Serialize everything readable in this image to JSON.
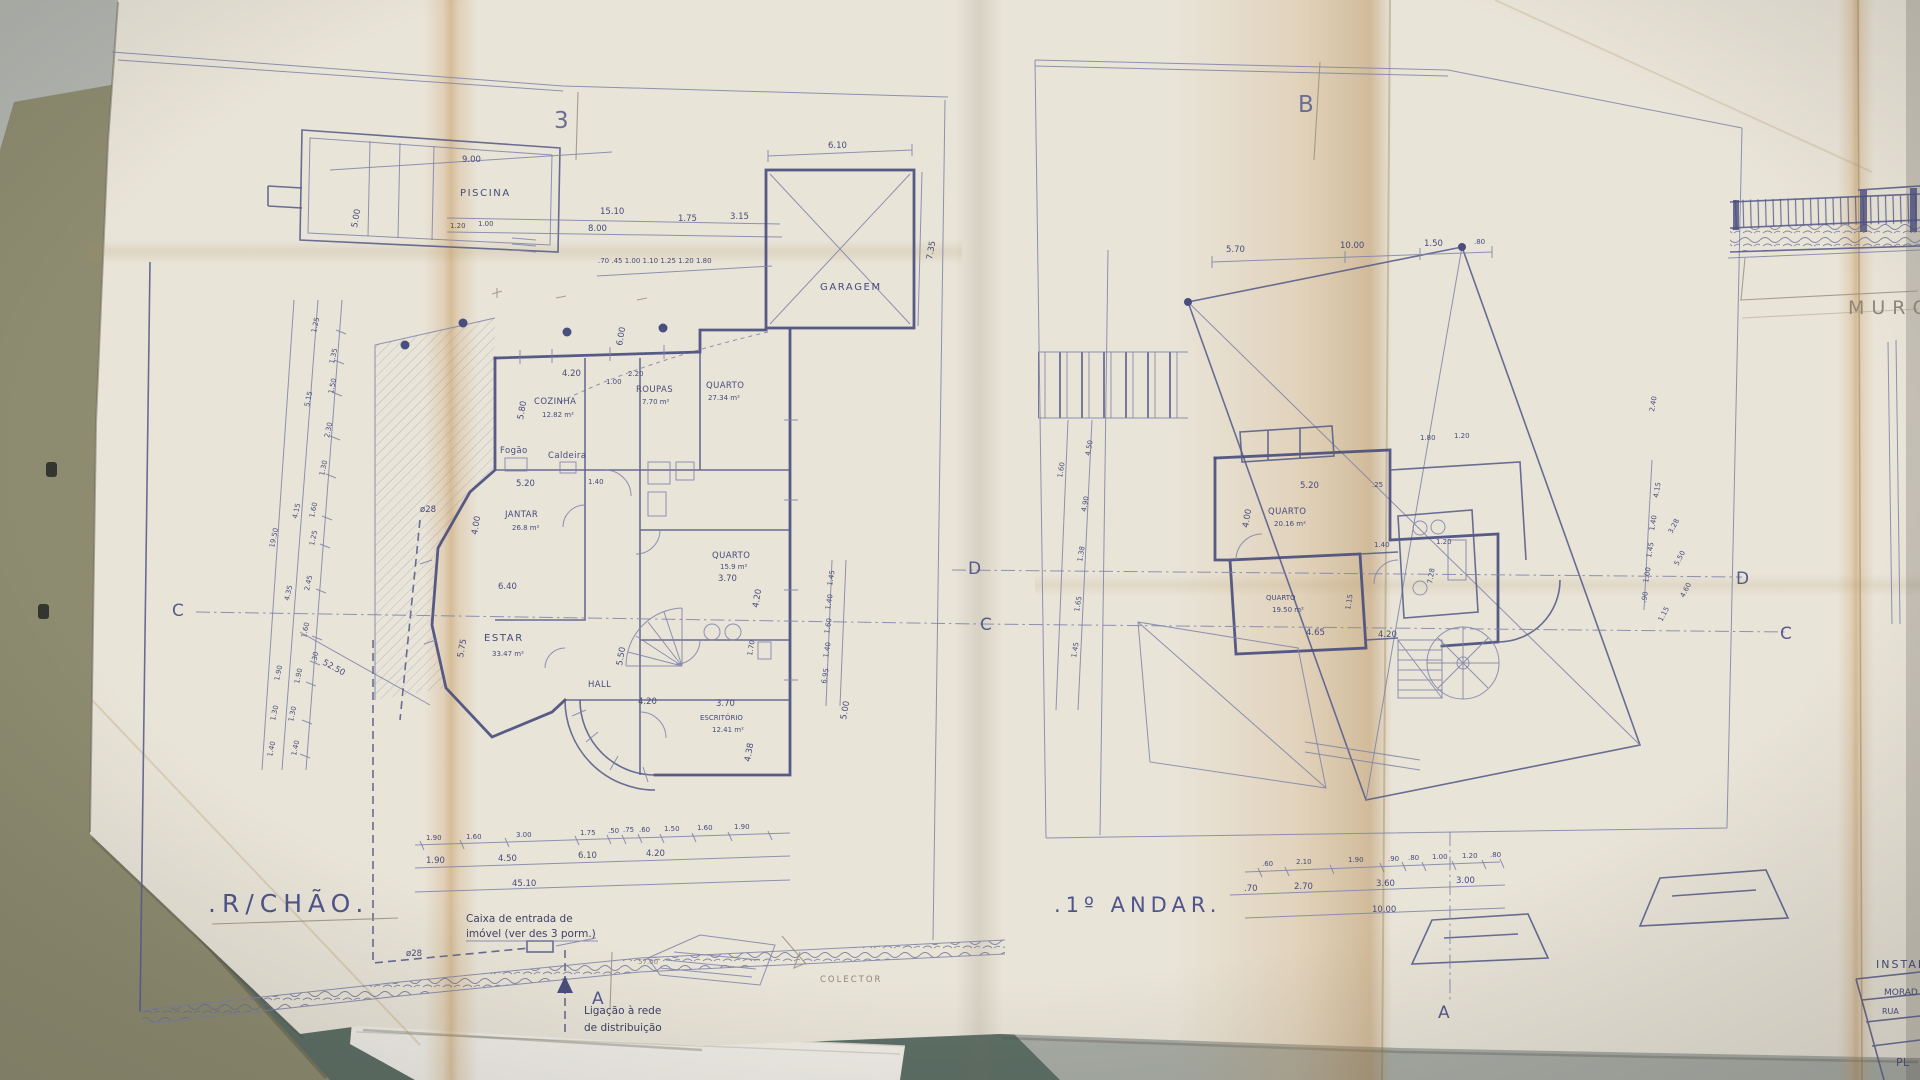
{
  "scene": {
    "desk_color": "#b4b7b1",
    "folder_color": "#8e8c70",
    "mat_color": "#5d6f66",
    "paper_color": "#e9e4d8",
    "ink_color": "#4a4e7e",
    "pencil_color": "#938c7c",
    "crease_color": "#c89a5e"
  },
  "markers": {
    "fold_left": "3",
    "fold_right": "B",
    "sec_c_left": "C",
    "sec_d_mid": "D",
    "sec_c_mid": "C",
    "sec_d_right": "D",
    "sec_c_right": "C",
    "sec_a_left": "A",
    "sec_a_right": "A"
  },
  "ground_floor": {
    "title": ".R/CHÃO.",
    "rooms": {
      "pool": "PISCINA",
      "garage": "GARAGEM",
      "kitchen": "COZINHA",
      "kitchen_area": "12.82 m²",
      "laundry": "ROUPAS",
      "laundry_area": "7.70 m²",
      "bedroom_top": "QUARTO",
      "bedroom_top_area": "27.34 m²",
      "dining": "JANTAR",
      "dining_area": "26.8 m²",
      "living": "ESTAR",
      "living_area": "33.47 m²",
      "hall": "HALL",
      "bedroom": "QUARTO",
      "bedroom_area": "15.9 m²",
      "office": "ESCRITÓRIO",
      "office_area": "12.41 m²",
      "stove": "Fogão",
      "boiler": "Caldeira"
    },
    "notes": {
      "inlet_1": "Caixa de entrada de",
      "inlet_2": "imóvel (ver des 3 porm.)",
      "pipe": "ø28",
      "pipe2": "ø28",
      "grid_1": "Ligação à rede",
      "grid_2": "de distribuição",
      "collector": "COLECTOR",
      "level": "57.00"
    },
    "dims": {
      "pool_w": "9.00",
      "pool_h": "5.00",
      "pool_off1": "15.10",
      "pool_off2": "8.00",
      "pool_s1": "1.20",
      "pool_s2": "1.00",
      "garage_w": "6.10",
      "garage_h": "7.35",
      "g1": "1.75",
      "g2": "3.15",
      "tiny_row": ".70 .45 1.00 1.10 1.25 1.20 1.80",
      "k1": "4.20",
      "k2": "1.00",
      "k3": "2.20",
      "k4": "5.80",
      "d1": "5.20",
      "d2": "1.40",
      "d3": "4.00",
      "d4": "6.40",
      "e1": "5.75",
      "h1": "5.50",
      "h2": "4.20",
      "q1": "3.70",
      "q2": "4.20",
      "q3": "1.70",
      "o1": "3.70",
      "o2": "4.38",
      "r1": "1.45",
      "r2": "1.40",
      "r3": "1.60",
      "r4": "1.40",
      "r5": "6.95",
      "r6": "5.00",
      "v6": "6.00",
      "diag": "52.50",
      "left_outer": [
        "5.15",
        "4.15",
        "19.50",
        "4.35",
        "1.90",
        "1.30",
        "1.40"
      ],
      "left_inner": [
        "1.25",
        "1.35",
        "1.50",
        "2.30",
        "1.30",
        "1.60",
        "1.25",
        "2.45",
        "1.60",
        ".30",
        "1.90",
        "1.30",
        "1.40"
      ],
      "bot1": [
        "1.90",
        "1.60",
        "3.00",
        "1.75",
        ".50",
        ".75",
        ".60",
        "1.50",
        "1.60",
        "1.90"
      ],
      "bot2": [
        "1.90",
        "4.50",
        "6.10",
        "4.20"
      ],
      "bot3": "45.10"
    }
  },
  "first_floor": {
    "title": ".1º ANDAR.",
    "rooms": {
      "bedroom1": "QUARTO",
      "bedroom1_area": "20.16 m²",
      "bedroom2": "QUARTO",
      "bedroom2_area": "19.50 m²",
      "bath_area": "7.28"
    },
    "dims": {
      "top": [
        "5.70",
        "10.00",
        "1.50",
        ".80"
      ],
      "left": [
        "1.60",
        "4.50",
        "4.90",
        "1.38",
        "1.65",
        "1.45"
      ],
      "right": [
        "2.40",
        "4.15",
        "1.40",
        "1.45",
        "1.00",
        ".90"
      ],
      "right_diag": [
        "3.28",
        "5.50",
        "4.60",
        "1.15"
      ],
      "b1": "5.20",
      "b2": ".25",
      "b3": "4.00",
      "b4": "1.40",
      "b5": "1.20",
      "b6": "4.65",
      "b7": "4.20",
      "b8": "1.15",
      "w1": "1.80",
      "w2": "1.20",
      "bot1": [
        ".60",
        "2.10",
        "1.90",
        ".90",
        ".80",
        "1.00",
        "1.20",
        ".80"
      ],
      "bot2": [
        ".70",
        "2.70",
        "3.60",
        "3.00"
      ],
      "bot3": "10.00"
    }
  },
  "side_panel": {
    "wall_label": "MURO",
    "block_header": "INSTAL",
    "block_rows": [
      "MORAD",
      "RUA",
      "PL"
    ]
  }
}
